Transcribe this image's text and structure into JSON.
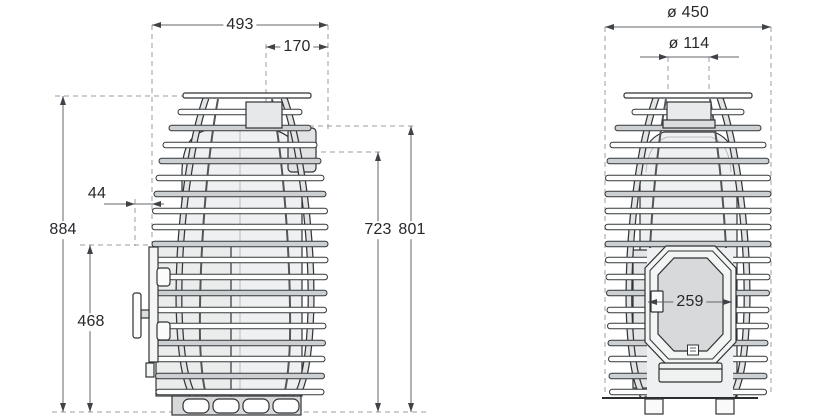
{
  "colors": {
    "line": "#2f3234",
    "dimension_line": "#606468",
    "arrow": "#3f4347",
    "dashed_guide": "#989c9f",
    "body_fill": "#eff0f1",
    "rail_fill": "#cdd0d2",
    "glass_fill": "#d8d9da",
    "background": "#ffffff"
  },
  "side_view": {
    "dim_overall_width": "493",
    "dim_flue_offset": "170",
    "dim_door_protrusion": "44",
    "dim_overall_height": "884",
    "dim_firebox_top_height": "468",
    "dim_rear_outlet_height_inner": "723",
    "dim_rear_outlet_height_outer": "801"
  },
  "front_view": {
    "dim_outer_diameter": "ø 450",
    "dim_flue_diameter": "ø 114",
    "dim_door_width": "259"
  }
}
